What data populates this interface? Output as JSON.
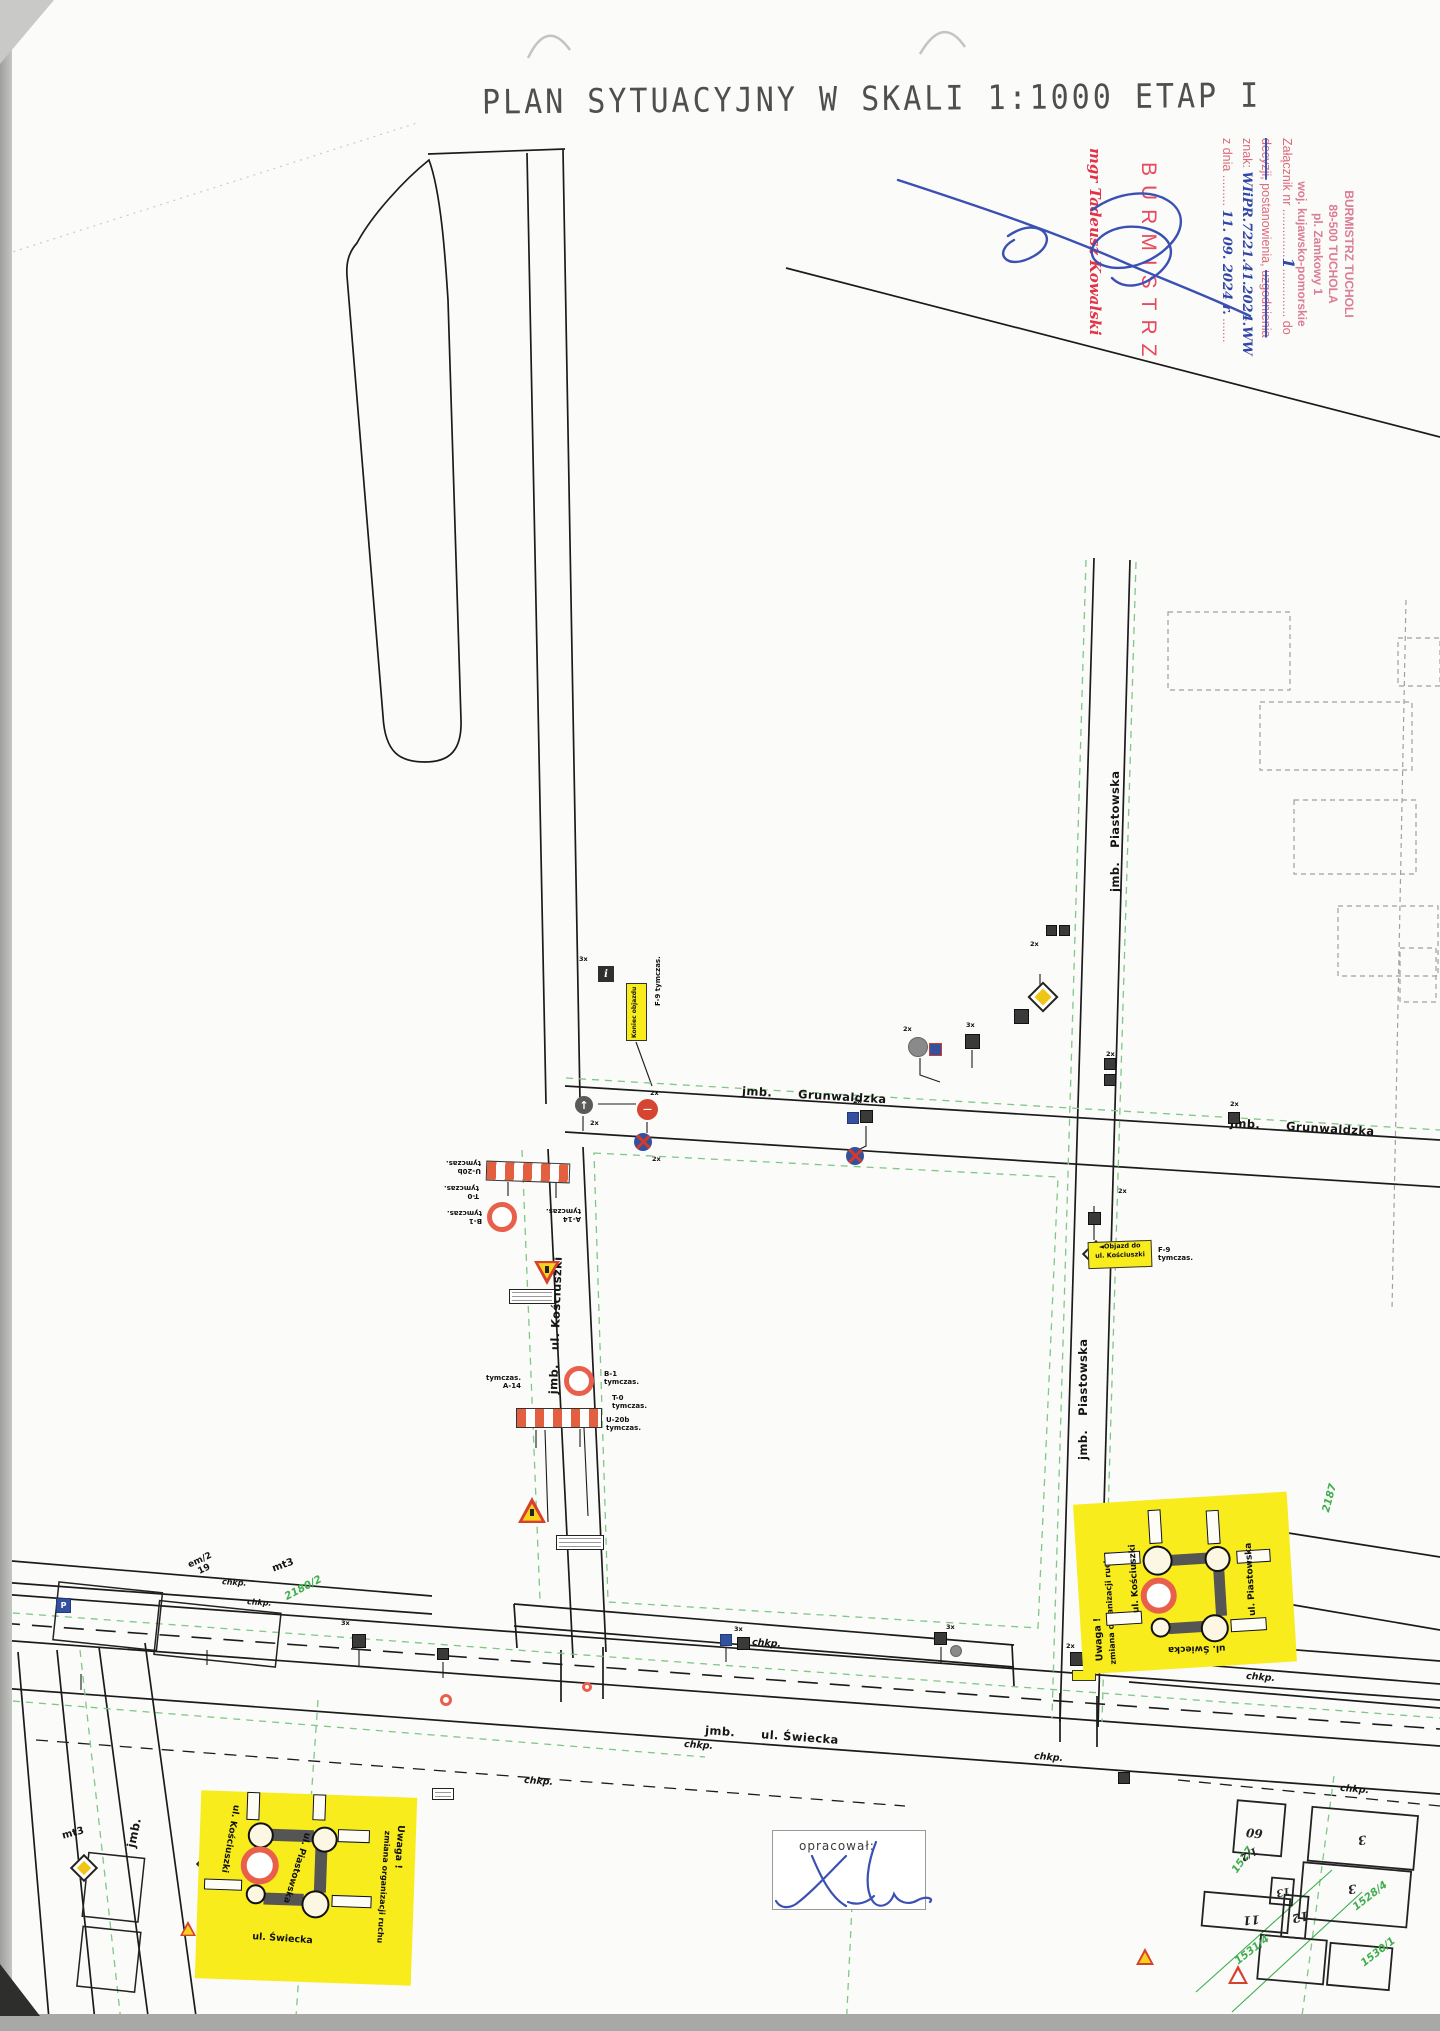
{
  "title": "PLAN SYTUACYJNY W SKALI 1:1000 ETAP I",
  "stamps": {
    "attachment": {
      "label": "Załącznik nr",
      "dots_a": "..............",
      "number": "1",
      "dots_b": "..............",
      "to": "do",
      "struck_1": "decyzji,",
      "middle": "postanowienia,",
      "struck_2": "uzgodnienia",
      "znak_label": "znak:",
      "znak_value": "WIiPR.7221.41.2024.WW",
      "date_label": "z dnia",
      "date_dots": ".........",
      "date_value": "11. 09. 2024 r.",
      "date_dots2": "......."
    },
    "office": {
      "line1": "BURMISTRZ TUCHOLI",
      "line2": "89-500 TUCHOLA",
      "line3": "pl. Zamkowy 1",
      "line4": "woj. kujawsko-pomorskie"
    },
    "burmistrz": "BURMISTRZ",
    "signer": "mgr Tadeusz Kowalski"
  },
  "streets": {
    "jmb": "jmb.",
    "grunwaldzka": "Grunwaldzka",
    "piastowska": "Piastowska",
    "kosciuszki": "ul. Kościuszki",
    "swiecka": "ul. Świecka",
    "chkp": "chkp."
  },
  "signs": {
    "b1": "B-1",
    "t0": "T-0",
    "u20b": "U-20b",
    "a14": "A-14",
    "f9": "F-9",
    "tym": "tymczas.",
    "x2": "2x",
    "x3": "3x",
    "arrow": "◄",
    "koniec_objazdu": "Koniec objazdu",
    "objazd_line1": "Objazd do",
    "objazd_line2": "ul. Kościuszki"
  },
  "notice": {
    "uwaga": "Uwaga !",
    "zmiana": "zmiana organizacji ruchu",
    "kosciuszki": "ul. Kościuszki",
    "piastowska": "ul. Piastowska",
    "swiecka": "ul. Świecka"
  },
  "annotations": {
    "opracowal": "opracował:",
    "mt3": "mt3",
    "em2": "em/2",
    "n19": "19"
  },
  "parcels": {
    "p2180": "2180/2",
    "p2187": "2187",
    "p1527": "1527",
    "p1528": "1528/4",
    "p1530": "1530/1",
    "p1531": "1531/4"
  },
  "buildings": {
    "b60": "60",
    "bhalf": "1/2",
    "b3a": "3",
    "b3b": "3",
    "b11": "11",
    "b12": "12",
    "b13": "13"
  },
  "colors": {
    "highlight_yellow": "#f8ec1c",
    "closure_red": "#e8604c",
    "stamp_pink": "#db7d94",
    "stamp_red": "#e84a5f",
    "pen_blue": "#3a50b2",
    "parcel_green": "#3fae4e"
  }
}
